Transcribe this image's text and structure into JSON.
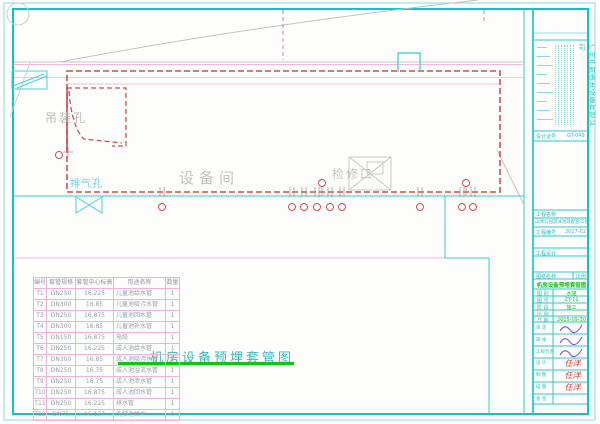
{
  "colors": {
    "frame": "#00c2c2",
    "red_dashed": "#cf4f4f",
    "pink": "#f2b8d8",
    "green": "#0ec60e",
    "gray": "#b5b5b5",
    "table_grid": "#efb3da",
    "handwriting_red": "#cf3535",
    "scribble_blue": "#7a6ad0"
  },
  "drawing": {
    "labels": {
      "hoist_hole": "吊装孔",
      "exhaust_hole": "排气孔",
      "equipment_room": "设备间",
      "access_port": "检修口"
    },
    "title": "机房设备预埋套管图"
  },
  "table": {
    "headers": [
      "编号",
      "套管规格",
      "套管中心标高",
      "用途名称",
      "数量"
    ],
    "rows": [
      [
        "T1",
        "DN250",
        "16.225",
        "儿童池给水管",
        "1"
      ],
      [
        "T2",
        "DN300",
        "16.85",
        "儿童池吸污水管",
        "1"
      ],
      [
        "T3",
        "DN250",
        "16.875",
        "儿童池回水管",
        "1"
      ],
      [
        "T4",
        "DN300",
        "16.85",
        "儿童池补水管",
        "1"
      ],
      [
        "T5",
        "DN150",
        "16.875",
        "电缆",
        "1"
      ],
      [
        "T6",
        "DN250",
        "16.225",
        "成人池给水管",
        "1"
      ],
      [
        "T7",
        "DN300",
        "16.85",
        "成人池吸污水管",
        "1"
      ],
      [
        "T8",
        "DN250",
        "16.75",
        "成人池溢流水管",
        "1"
      ],
      [
        "T9",
        "DN250",
        "16.75",
        "成人池泄水管",
        "1"
      ],
      [
        "T10",
        "DN250",
        "16.875",
        "成人池回水管",
        "1"
      ],
      [
        "T11",
        "DN250",
        "16.225",
        "排水管",
        "1"
      ],
      [
        "T12",
        "DN75",
        "16.137",
        "洗脚池给水",
        "1"
      ]
    ]
  },
  "titleblock": {
    "company": "广州中朗康体设备有限公司",
    "cert_label": "设计证号",
    "cert_value": "GT-049",
    "fields": [
      {
        "label": "工程名称",
        "value": ""
      },
      {
        "label": "工程编号",
        "value": "2017-02"
      },
      {
        "label": "工程设计",
        "value": ""
      }
    ],
    "project_name": "山体公园游泳池及配套工程",
    "sheet_name_label": "图纸名称",
    "scale_label": "比例",
    "drawing_name": "机房设备预埋套管图",
    "small_fields": [
      {
        "label": "图 别",
        "value": "水施"
      },
      {
        "label": "图 号",
        "value": "ZY-11"
      },
      {
        "label": "阶 段",
        "value": "施工"
      },
      {
        "label": "比 例",
        "value": ""
      },
      {
        "label": "日 期",
        "value": "2015-09-30"
      }
    ],
    "sign_fields": [
      {
        "label": "审 定",
        "value": ""
      },
      {
        "label": "审 核",
        "value": ""
      },
      {
        "label": "工程负责",
        "value": ""
      },
      {
        "label": "设 计",
        "value": "任洋"
      },
      {
        "label": "制 图",
        "value": "任洋"
      },
      {
        "label": "描 图",
        "value": "任洋"
      },
      {
        "label": "会 签",
        "value": ""
      }
    ]
  }
}
